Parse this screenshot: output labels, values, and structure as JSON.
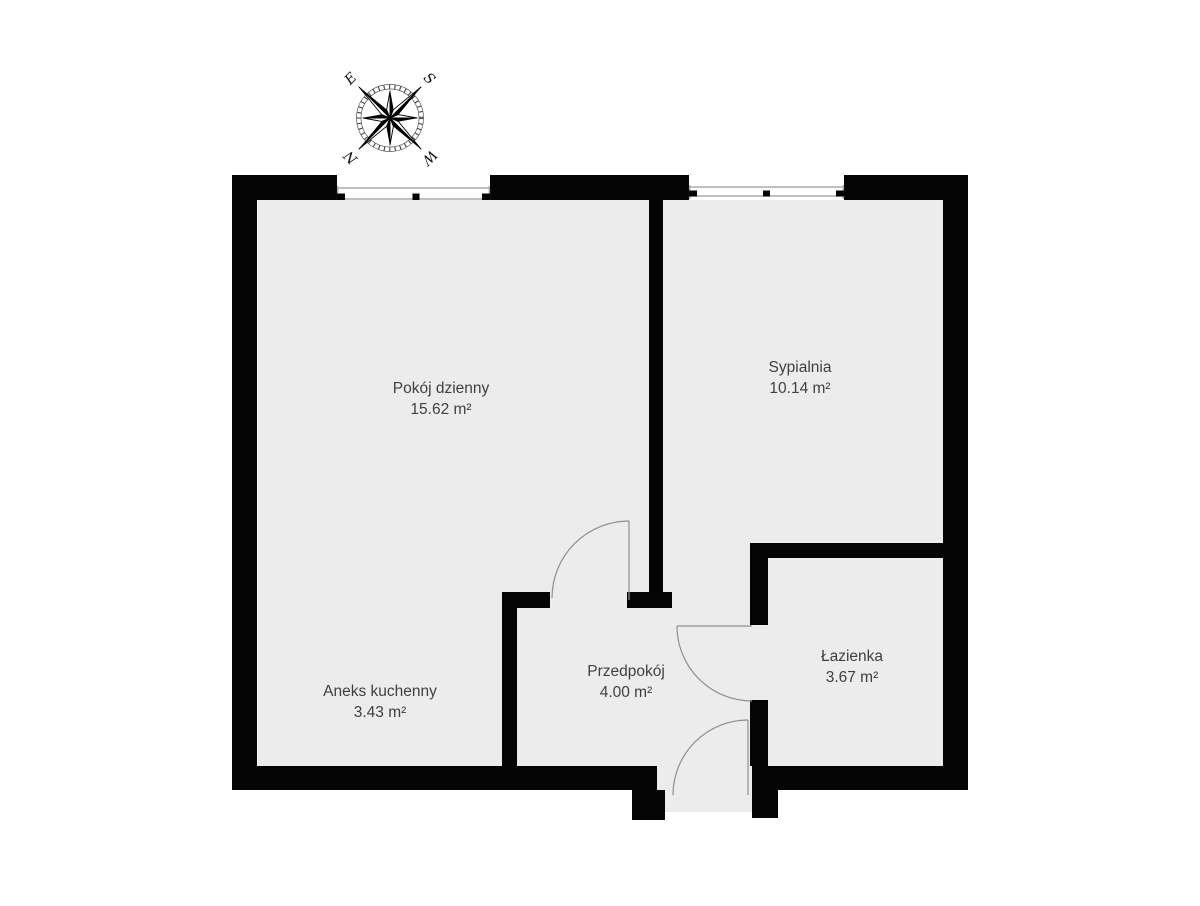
{
  "colors": {
    "wall": "#050505",
    "floor": "#ececec",
    "label-text": "#3f3f3f",
    "door-line": "#8f8f8f",
    "window-line": "#ababab",
    "background": "#ffffff"
  },
  "compass": {
    "north": "N",
    "south": "S",
    "east": "E",
    "west": "W"
  },
  "rooms": [
    {
      "name": "Pokój dzienny",
      "area": "15.62 m²"
    },
    {
      "name": "Sypialnia",
      "area": "10.14 m²"
    },
    {
      "name": "Aneks kuchenny",
      "area": "3.43 m²"
    },
    {
      "name": "Przedpokój",
      "area": "4.00 m²"
    },
    {
      "name": "Łazienka",
      "area": "3.67 m²"
    }
  ]
}
